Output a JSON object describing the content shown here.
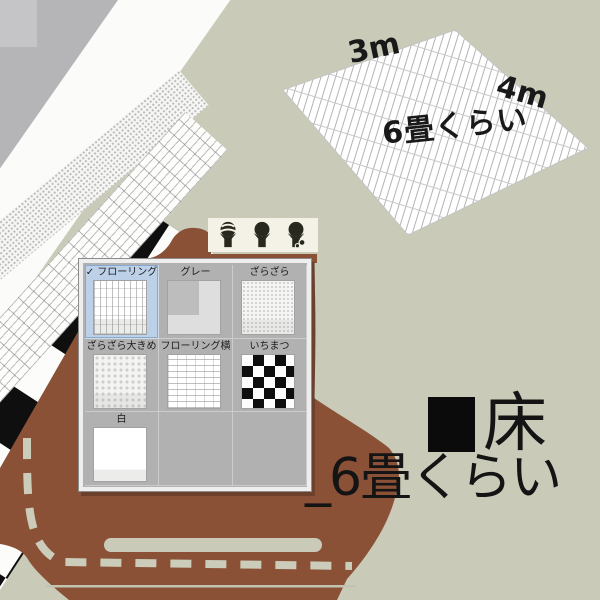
{
  "colors": {
    "background": "#c9cbb8",
    "blob_brown": "#8a5137",
    "selection_blue": "#bcd0e8",
    "panel_gray": "#b1b1b1",
    "sheet_gray": "#b5b5b7",
    "toolbar_cream": "#f4f2e6"
  },
  "sketch": {
    "width_label": "3m",
    "depth_label": "4m",
    "area_label": "6畳くらい"
  },
  "caption": {
    "heading": "床",
    "subheading": "_6畳くらい"
  },
  "toolbar": {
    "buttons": [
      {
        "icon": "hand-with-striped-ball"
      },
      {
        "icon": "hand-with-ball"
      },
      {
        "icon": "hand-with-ball-and-gear"
      }
    ]
  },
  "palette": {
    "check_glyph": "✓",
    "items": [
      {
        "label": "フローリング",
        "selected": true
      },
      {
        "label": "グレー",
        "selected": false
      },
      {
        "label": "ざらざら",
        "selected": false
      },
      {
        "label": "ざらざら大きめ",
        "selected": false
      },
      {
        "label": "フローリング横",
        "selected": false
      },
      {
        "label": "いちまつ",
        "selected": false
      },
      {
        "label": "白",
        "selected": false
      }
    ]
  }
}
